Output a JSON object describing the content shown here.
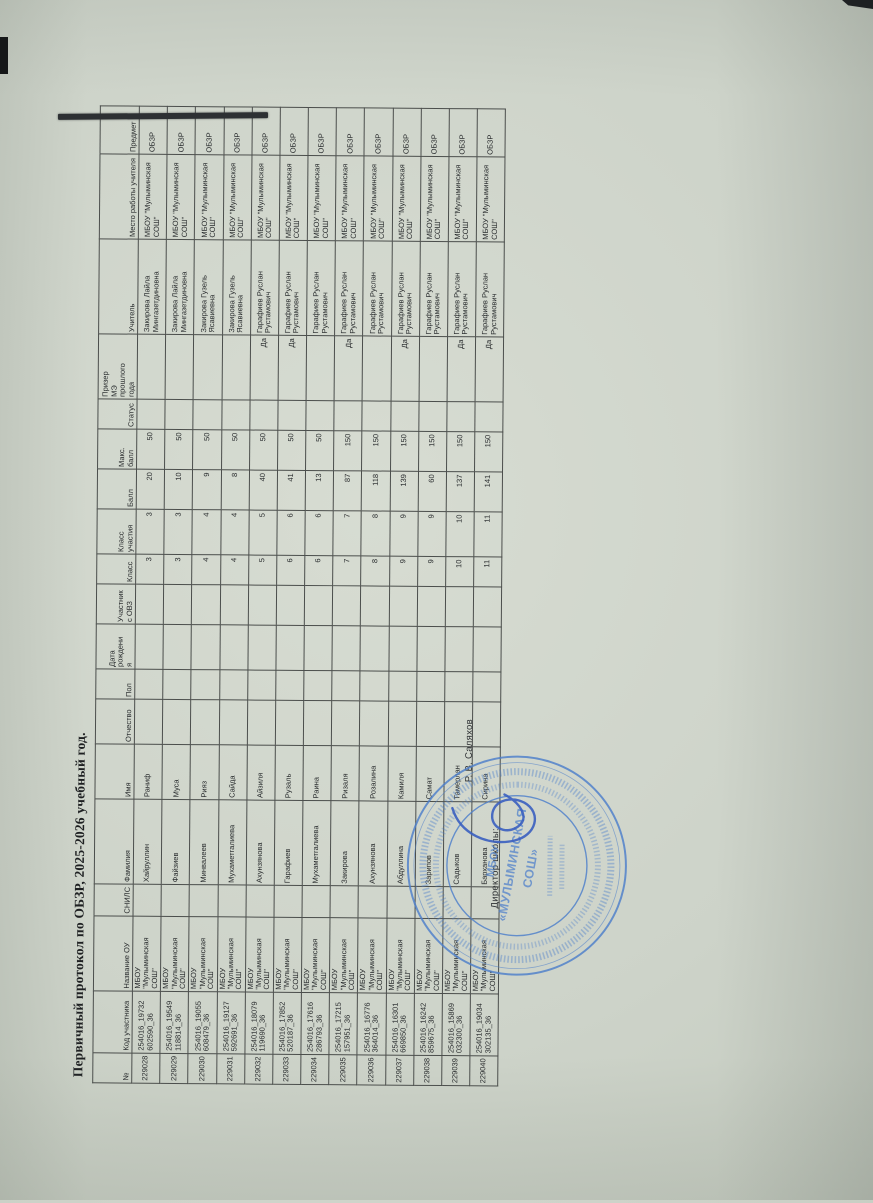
{
  "page": {
    "title": "Первичный протокол по ОБЗР, 2025-2026 учебный год."
  },
  "table": {
    "columns": [
      "№",
      "Код участника",
      "Название ОУ",
      "СНИЛС",
      "Фамилия",
      "Имя",
      "Отчество",
      "Пол",
      "Дата\nрождени\nя",
      "Участник\nс ОВЗ",
      "Класс",
      "Класс\nучастия",
      "Балл",
      "Макс.\nбалл",
      "Статус",
      "Призер\nМЭ\nпрошлого\nгода",
      "Учитель",
      "Место работы учителя",
      "Предмет"
    ],
    "rows": [
      [
        "229028",
        "254016_19732\n602590_36",
        "МБОУ \"Мулыминская СОШ\"",
        "",
        "Хайруллин",
        "Раниф",
        "",
        "",
        "",
        "",
        "3",
        "3",
        "20",
        "50",
        "",
        "",
        "Закирова Лайла Мингазетдиновна",
        "МБОУ \"Мулыминская СОШ\"",
        "ОБЗР"
      ],
      [
        "229029",
        "254016_19549\n118814_36",
        "МБОУ \"Мулыминская СОШ\"",
        "",
        "Файзиев",
        "Муса",
        "",
        "",
        "",
        "",
        "3",
        "3",
        "10",
        "50",
        "",
        "",
        "Закирова Лайла Мингазетдиновна",
        "МБОУ \"Мулыминская СОШ\"",
        "ОБЗР"
      ],
      [
        "229030",
        "254016_19055\n608479_36",
        "МБОУ \"Мулыминская СОШ\"",
        "",
        "Минвалеев",
        "Рияз",
        "",
        "",
        "",
        "",
        "4",
        "4",
        "9",
        "50",
        "",
        "",
        "Закирова Гузель Ясавиевна",
        "МБОУ \"Мулыминская СОШ\"",
        "ОБЗР"
      ],
      [
        "229031",
        "254016_19127\n592691_36",
        "МБОУ \"Мулыминская СОШ\"",
        "",
        "Мухаметгалиева",
        "Сайда",
        "",
        "",
        "",
        "",
        "4",
        "4",
        "8",
        "50",
        "",
        "",
        "Закирова Гузель Ясавиевна",
        "МБОУ \"Мулыминская СОШ\"",
        "ОБЗР"
      ],
      [
        "229032",
        "254016_18079\n119690_36",
        "МБОУ \"Мулыминская СОШ\"",
        "",
        "Ахунзянова",
        "Айзиля",
        "",
        "",
        "",
        "",
        "5",
        "5",
        "40",
        "50",
        "",
        "Да",
        "Гарафиев Руслан Рустамович",
        "МБОУ \"Мулыминская СОШ\"",
        "ОБЗР"
      ],
      [
        "229033",
        "254016_17852\n520187_36",
        "МБОУ \"Мулыминская СОШ\"",
        "",
        "Гарафиев",
        "Рузаль",
        "",
        "",
        "",
        "",
        "6",
        "6",
        "41",
        "50",
        "",
        "Да",
        "Гарафиев Руслан Рустамович",
        "МБОУ \"Мулыминская СОШ\"",
        "ОБЗР"
      ],
      [
        "229034",
        "254016_17616\n286793_36",
        "МБОУ \"Мулыминская СОШ\"",
        "",
        "Мухаметгалиева",
        "Раина",
        "",
        "",
        "",
        "",
        "6",
        "6",
        "13",
        "50",
        "",
        "",
        "Гарафиев Руслан Рустамович",
        "МБОУ \"Мулыминская СОШ\"",
        "ОБЗР"
      ],
      [
        "229035",
        "254016_17215\n157951_36",
        "МБОУ \"Мулыминская СОШ\"",
        "",
        "Закирова",
        "Ризаля",
        "",
        "",
        "",
        "",
        "7",
        "7",
        "87",
        "150",
        "",
        "Да",
        "Гарафиев Руслан Рустамович",
        "МБОУ \"Мулыминская СОШ\"",
        "ОБЗР"
      ],
      [
        "229036",
        "254016_16776\n364014_36",
        "МБОУ \"Мулыминская СОШ\"",
        "",
        "Ахунзянова",
        "Розалина",
        "",
        "",
        "",
        "",
        "8",
        "8",
        "118",
        "150",
        "",
        "",
        "Гарафиев Руслан Рустамович",
        "МБОУ \"Мулыминская СОШ\"",
        "ОБЗР"
      ],
      [
        "229037",
        "254016_16301\n669850_36",
        "МБОУ \"Мулыминская СОШ\"",
        "",
        "Абдуллина",
        "Камиля",
        "",
        "",
        "",
        "",
        "9",
        "9",
        "139",
        "150",
        "",
        "Да",
        "Гарафиев Руслан Рустамович",
        "МБОУ \"Мулыминская СОШ\"",
        "ОБЗР"
      ],
      [
        "229038",
        "254016_16242\n859675_36",
        "МБОУ \"Мулыминская СОШ\"",
        "",
        "Зарипов",
        "Самат",
        "",
        "",
        "",
        "",
        "9",
        "9",
        "60",
        "150",
        "",
        "",
        "Гарафиев Руслан Рустамович",
        "МБОУ \"Мулыминская СОШ\"",
        "ОБЗР"
      ],
      [
        "229039",
        "254016_15869\n032300_36",
        "МБОУ \"Мулыминская СОШ\"",
        "",
        "Садыков",
        "Тамерлан",
        "",
        "",
        "",
        "",
        "10",
        "10",
        "137",
        "150",
        "",
        "Да",
        "Гарафиев Руслан Рустамович",
        "МБОУ \"Мулыминская СОШ\"",
        "ОБЗР"
      ],
      [
        "229040",
        "254016_19034\n302135_36",
        "МБОУ \"Мулыминская СОШ\"",
        "",
        "Барханова",
        "Сирина",
        "",
        "",
        "",
        "",
        "11",
        "11",
        "141",
        "150",
        "",
        "Да",
        "Гарафиев Руслан Рустамович",
        "МБОУ \"Мулыминская СОШ\"",
        "ОБЗР"
      ]
    ]
  },
  "signature": {
    "director_label": "Директор школы:",
    "director_name": "Р. В. Саляхов"
  },
  "stamp": {
    "line1": "МБОУ",
    "line2": "«МУЛЫМИНСКАЯ",
    "line3": "СОШ»"
  },
  "colors": {
    "paper": "#cdd3c9",
    "ink": "#292c2e",
    "table_line": "#4b4e4c",
    "stamp_blue": "#4d7fcb",
    "signature_blue": "#3a5fc0"
  }
}
